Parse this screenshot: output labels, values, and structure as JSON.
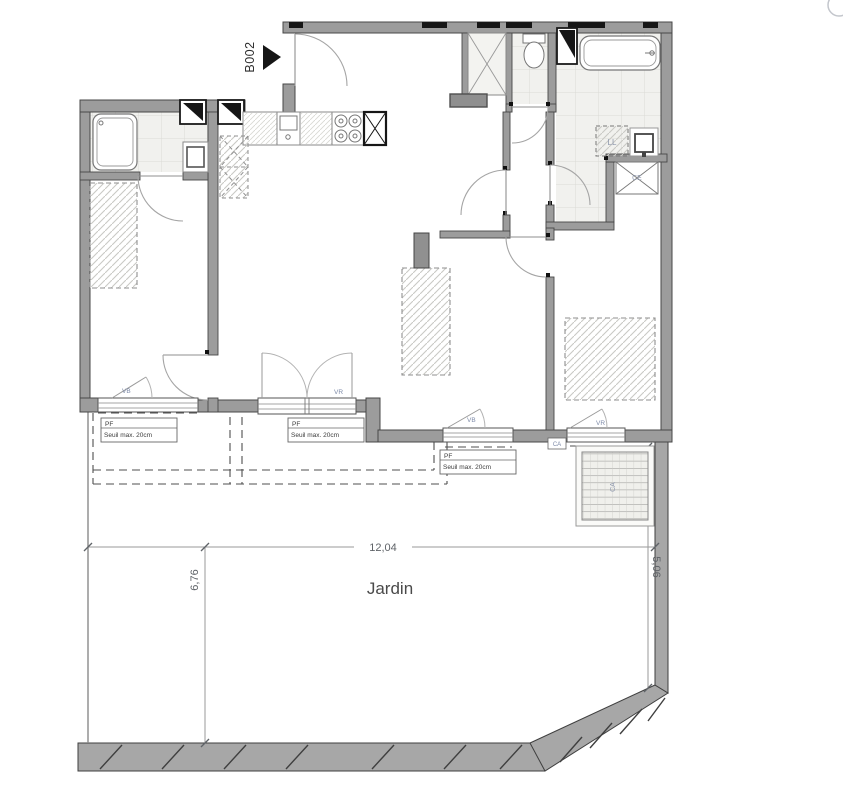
{
  "plan": {
    "unit": "B002",
    "garden": {
      "label": "Jardin"
    },
    "dimensions": {
      "width": "12,04",
      "left_depth": "6,76",
      "right_depth": "5,06"
    },
    "threshold_notes": [
      {
        "code": "PF",
        "text": "Seuil max. 20cm"
      },
      {
        "code": "PF",
        "text": "Seuil max. 20cm"
      },
      {
        "code": "PF",
        "text": "Seuil max. 20cm"
      }
    ],
    "opening_labels": [
      {
        "id": "bedroom1-window",
        "label": "VB"
      },
      {
        "id": "living-french-door",
        "label": "VR"
      },
      {
        "id": "living-window",
        "label": "VB"
      },
      {
        "id": "bedroom2-window",
        "label": "VR"
      }
    ],
    "equipment": {
      "washing_machine": "LL",
      "water_heater": "CE",
      "light_well": "CA"
    },
    "colors": {
      "wall": "#9c9c9c",
      "wall_outline": "#474747",
      "tile_floor": "#f1f1ee",
      "dim_text": "#5f6368",
      "label_blue": "#7d8aa8"
    }
  }
}
